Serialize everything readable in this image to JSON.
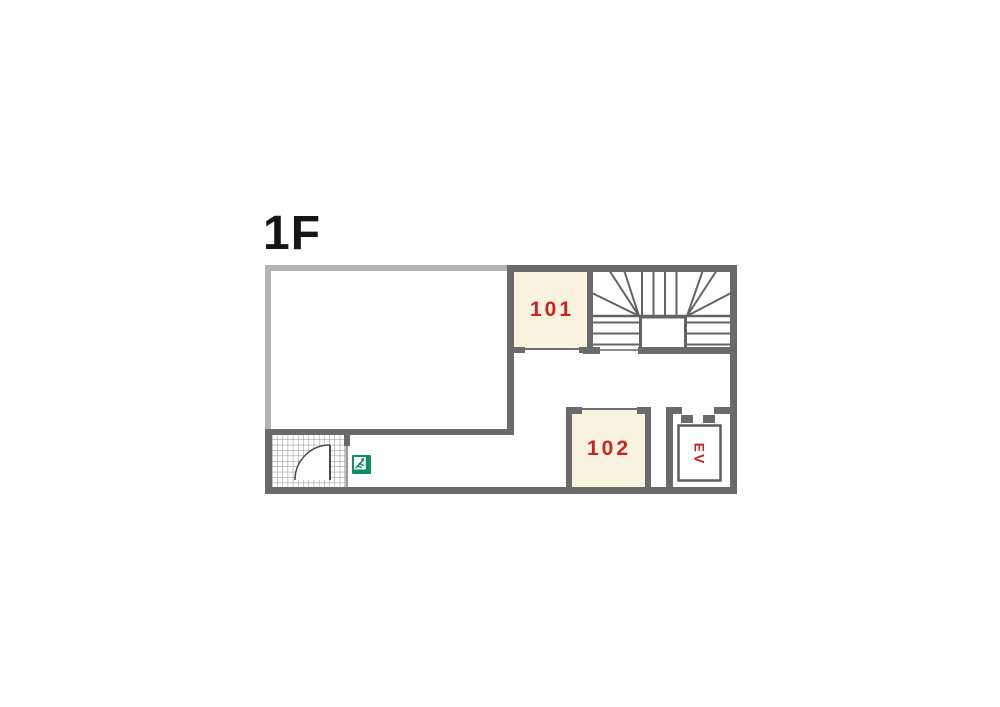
{
  "title": "1F",
  "rooms": {
    "room101": {
      "label": "101"
    },
    "room102": {
      "label": "102"
    },
    "elevator": {
      "label": "EV"
    }
  },
  "icons": {
    "exit_sign": "emergency-exit-running-man-icon"
  },
  "colors": {
    "wall_dark": "#6a6a6a",
    "wall_light": "#b3b3b3",
    "room_fill": "#f9f2df",
    "label_red": "#c9241f",
    "exit_green": "#0e8c68",
    "stair_line": "#636363",
    "grid_line": "#8f8f8f"
  }
}
